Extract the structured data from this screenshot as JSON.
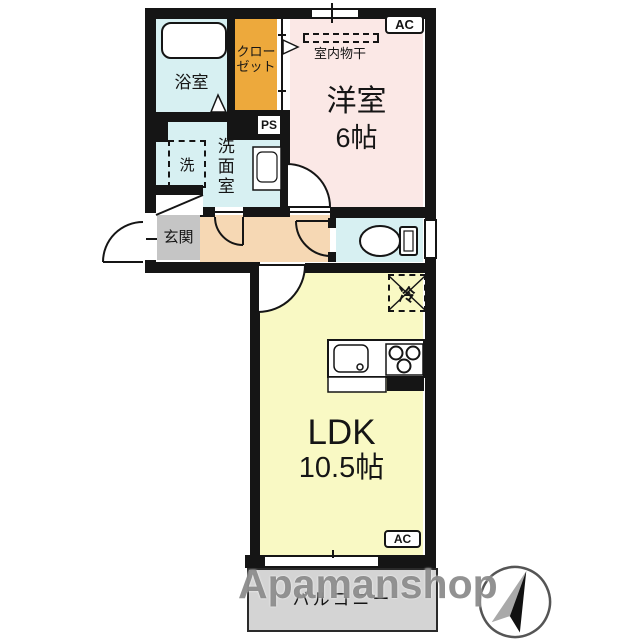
{
  "floorplan": {
    "colors": {
      "wall": "#151515",
      "water_rooms": "#d7f0f2",
      "western_room": "#fbe8e6",
      "closet": "#eda93c",
      "hallway": "#f6d8b4",
      "ldk": "#f9f9c4",
      "entrance": "#c5c5c5",
      "balcony": "#d4d4d4"
    },
    "bath": {
      "label": "浴室"
    },
    "closet": {
      "line1": "クロー",
      "line2": "ゼット"
    },
    "western_room": {
      "label": "洋室",
      "size": "6帖",
      "ac": "AC",
      "drying": "室内物干"
    },
    "washroom": {
      "label": "洗面室",
      "washer": "洗",
      "ps": "PS"
    },
    "entrance": {
      "label": "玄関"
    },
    "ldk": {
      "label": "LDK",
      "size": "10.5帖",
      "ac": "AC",
      "fridge": "冷"
    },
    "balcony": {
      "label": "バルコニー"
    },
    "watermark": "Apamanshop"
  }
}
